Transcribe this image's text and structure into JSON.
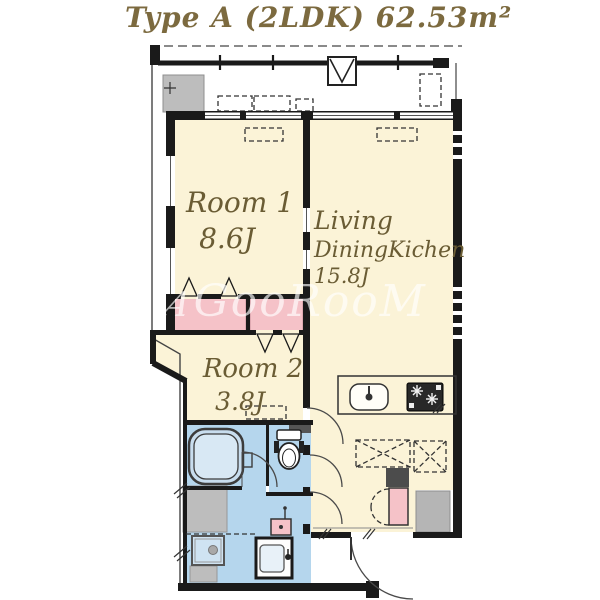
{
  "title": "Type A (2LDK) 62.53m²",
  "watermark": {
    "prefix": "A",
    "text": "GooRooM"
  },
  "rooms": {
    "room1": {
      "name": "Room 1",
      "size": "8.6J"
    },
    "room2": {
      "name": "Room 2",
      "size": "3.8J"
    },
    "ldk": {
      "name_line1": "Living",
      "name_line2": "DiningKichen",
      "size": "15.8J"
    }
  },
  "colors": {
    "floor_cream": "#fbf3d7",
    "closet_pink": "#f5c2c8",
    "wet_area_blue": "#b5d6ed",
    "utility_gray": "#bdbdbd",
    "wall_dark": "#1a1a1a",
    "label_olive": "#6a5c34",
    "title_gold": "#7c6a3f"
  }
}
